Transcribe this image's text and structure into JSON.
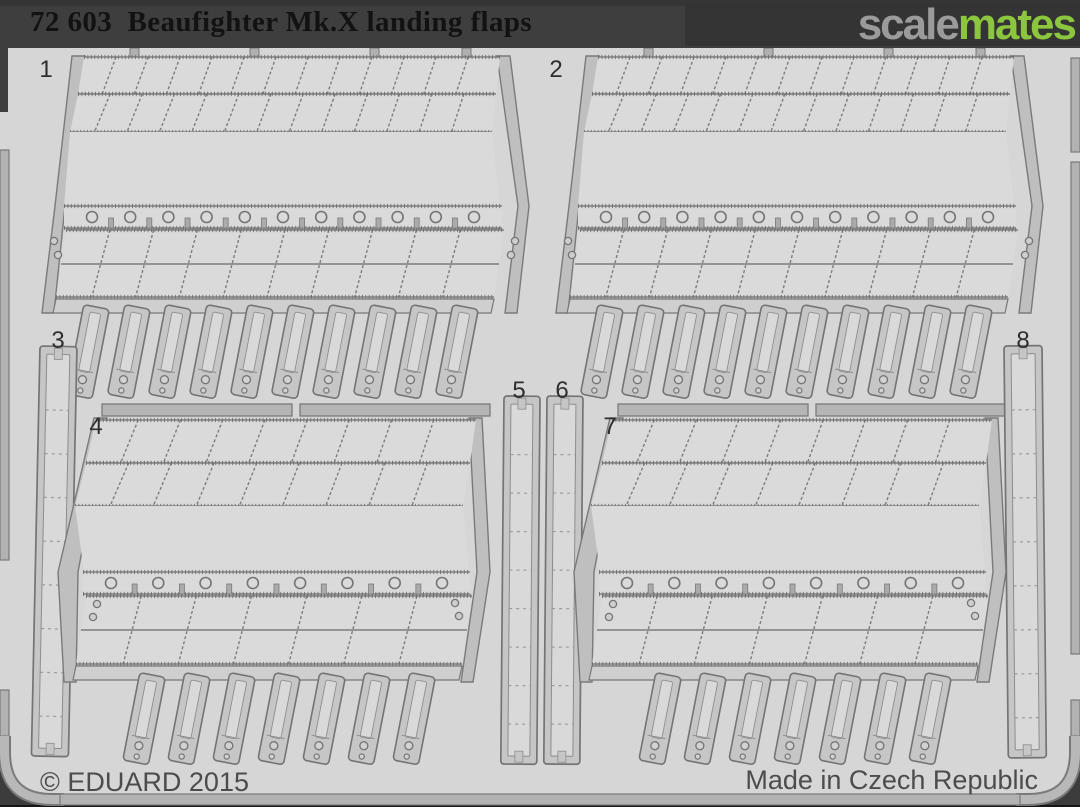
{
  "header": {
    "title": "72 603  Beaufighter Mk.X landing flaps",
    "logo": {
      "gray": "scale",
      "green": "mates"
    }
  },
  "sheet": {
    "part_labels": [
      "1",
      "2",
      "3",
      "4",
      "5",
      "6",
      "7",
      "8"
    ]
  },
  "footer": {
    "copyright": "© EDUARD 2015",
    "origin": "Made in Czech Republic"
  },
  "colors": {
    "header_bg": "#3e3e3e",
    "title_text": "#121212",
    "logo_gray": "#9b9b9b",
    "logo_green": "#8cc63e",
    "sheet_background": "#d6d6d6",
    "metal_part": "#c6c6c6",
    "etch_outline": "#757575",
    "footer_text": "#4c4c4c"
  }
}
